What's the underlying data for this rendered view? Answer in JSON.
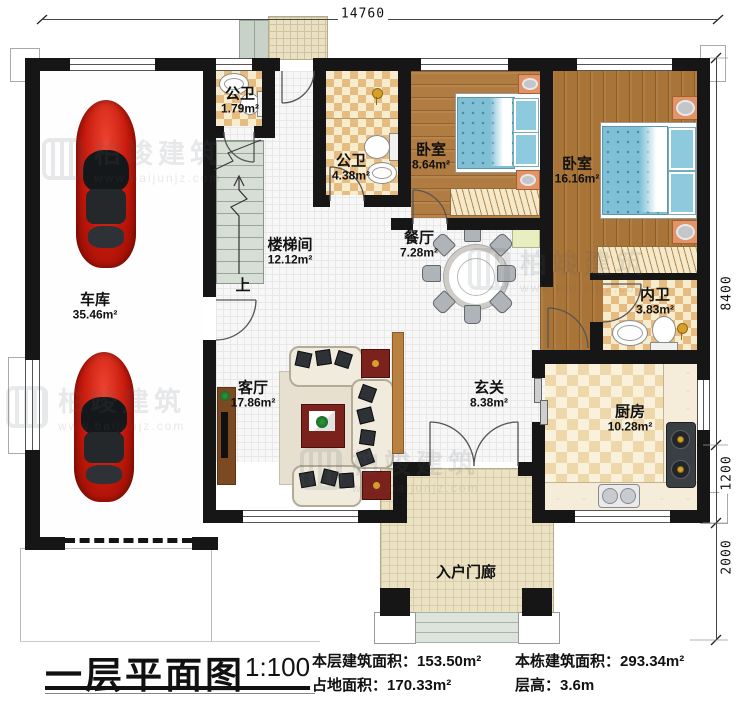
{
  "plan": {
    "title": "一层平面图",
    "scale": "1:100",
    "stats": [
      {
        "label": "本层建筑面积：",
        "value": "153.50m²"
      },
      {
        "label": "占地面积：",
        "value": "170.33m²"
      },
      {
        "label": "本栋建筑面积：",
        "value": "293.34m²"
      },
      {
        "label": "层高：",
        "value": "3.6m"
      }
    ]
  },
  "dimensions": {
    "top": "14760",
    "right_top": "8400",
    "right_mid": "1200",
    "right_bottom": "2000"
  },
  "rooms": {
    "garage": {
      "name": "车库",
      "area": "35.46m²"
    },
    "bath_small": {
      "name": "公卫",
      "area": "1.79m²"
    },
    "bath_main": {
      "name": "公卫",
      "area": "4.38m²"
    },
    "stairwell": {
      "name": "楼梯间",
      "area": "12.12m²"
    },
    "bedroom_small": {
      "name": "卧室",
      "area": "8.64m²"
    },
    "bedroom_large": {
      "name": "卧室",
      "area": "16.16m²"
    },
    "dining": {
      "name": "餐厅",
      "area": "7.28m²"
    },
    "living": {
      "name": "客厅",
      "area": "17.86m²"
    },
    "foyer": {
      "name": "玄关",
      "area": "8.38m²"
    },
    "ensuite": {
      "name": "内卫",
      "area": "3.83m²"
    },
    "kitchen": {
      "name": "厨房",
      "area": "10.28m²"
    },
    "porch": {
      "name": "入户门廊",
      "area": ""
    }
  },
  "stair_direction_label": "上",
  "watermark": {
    "brand": "柏竣建筑",
    "url": "www.baijunjz.com"
  }
}
